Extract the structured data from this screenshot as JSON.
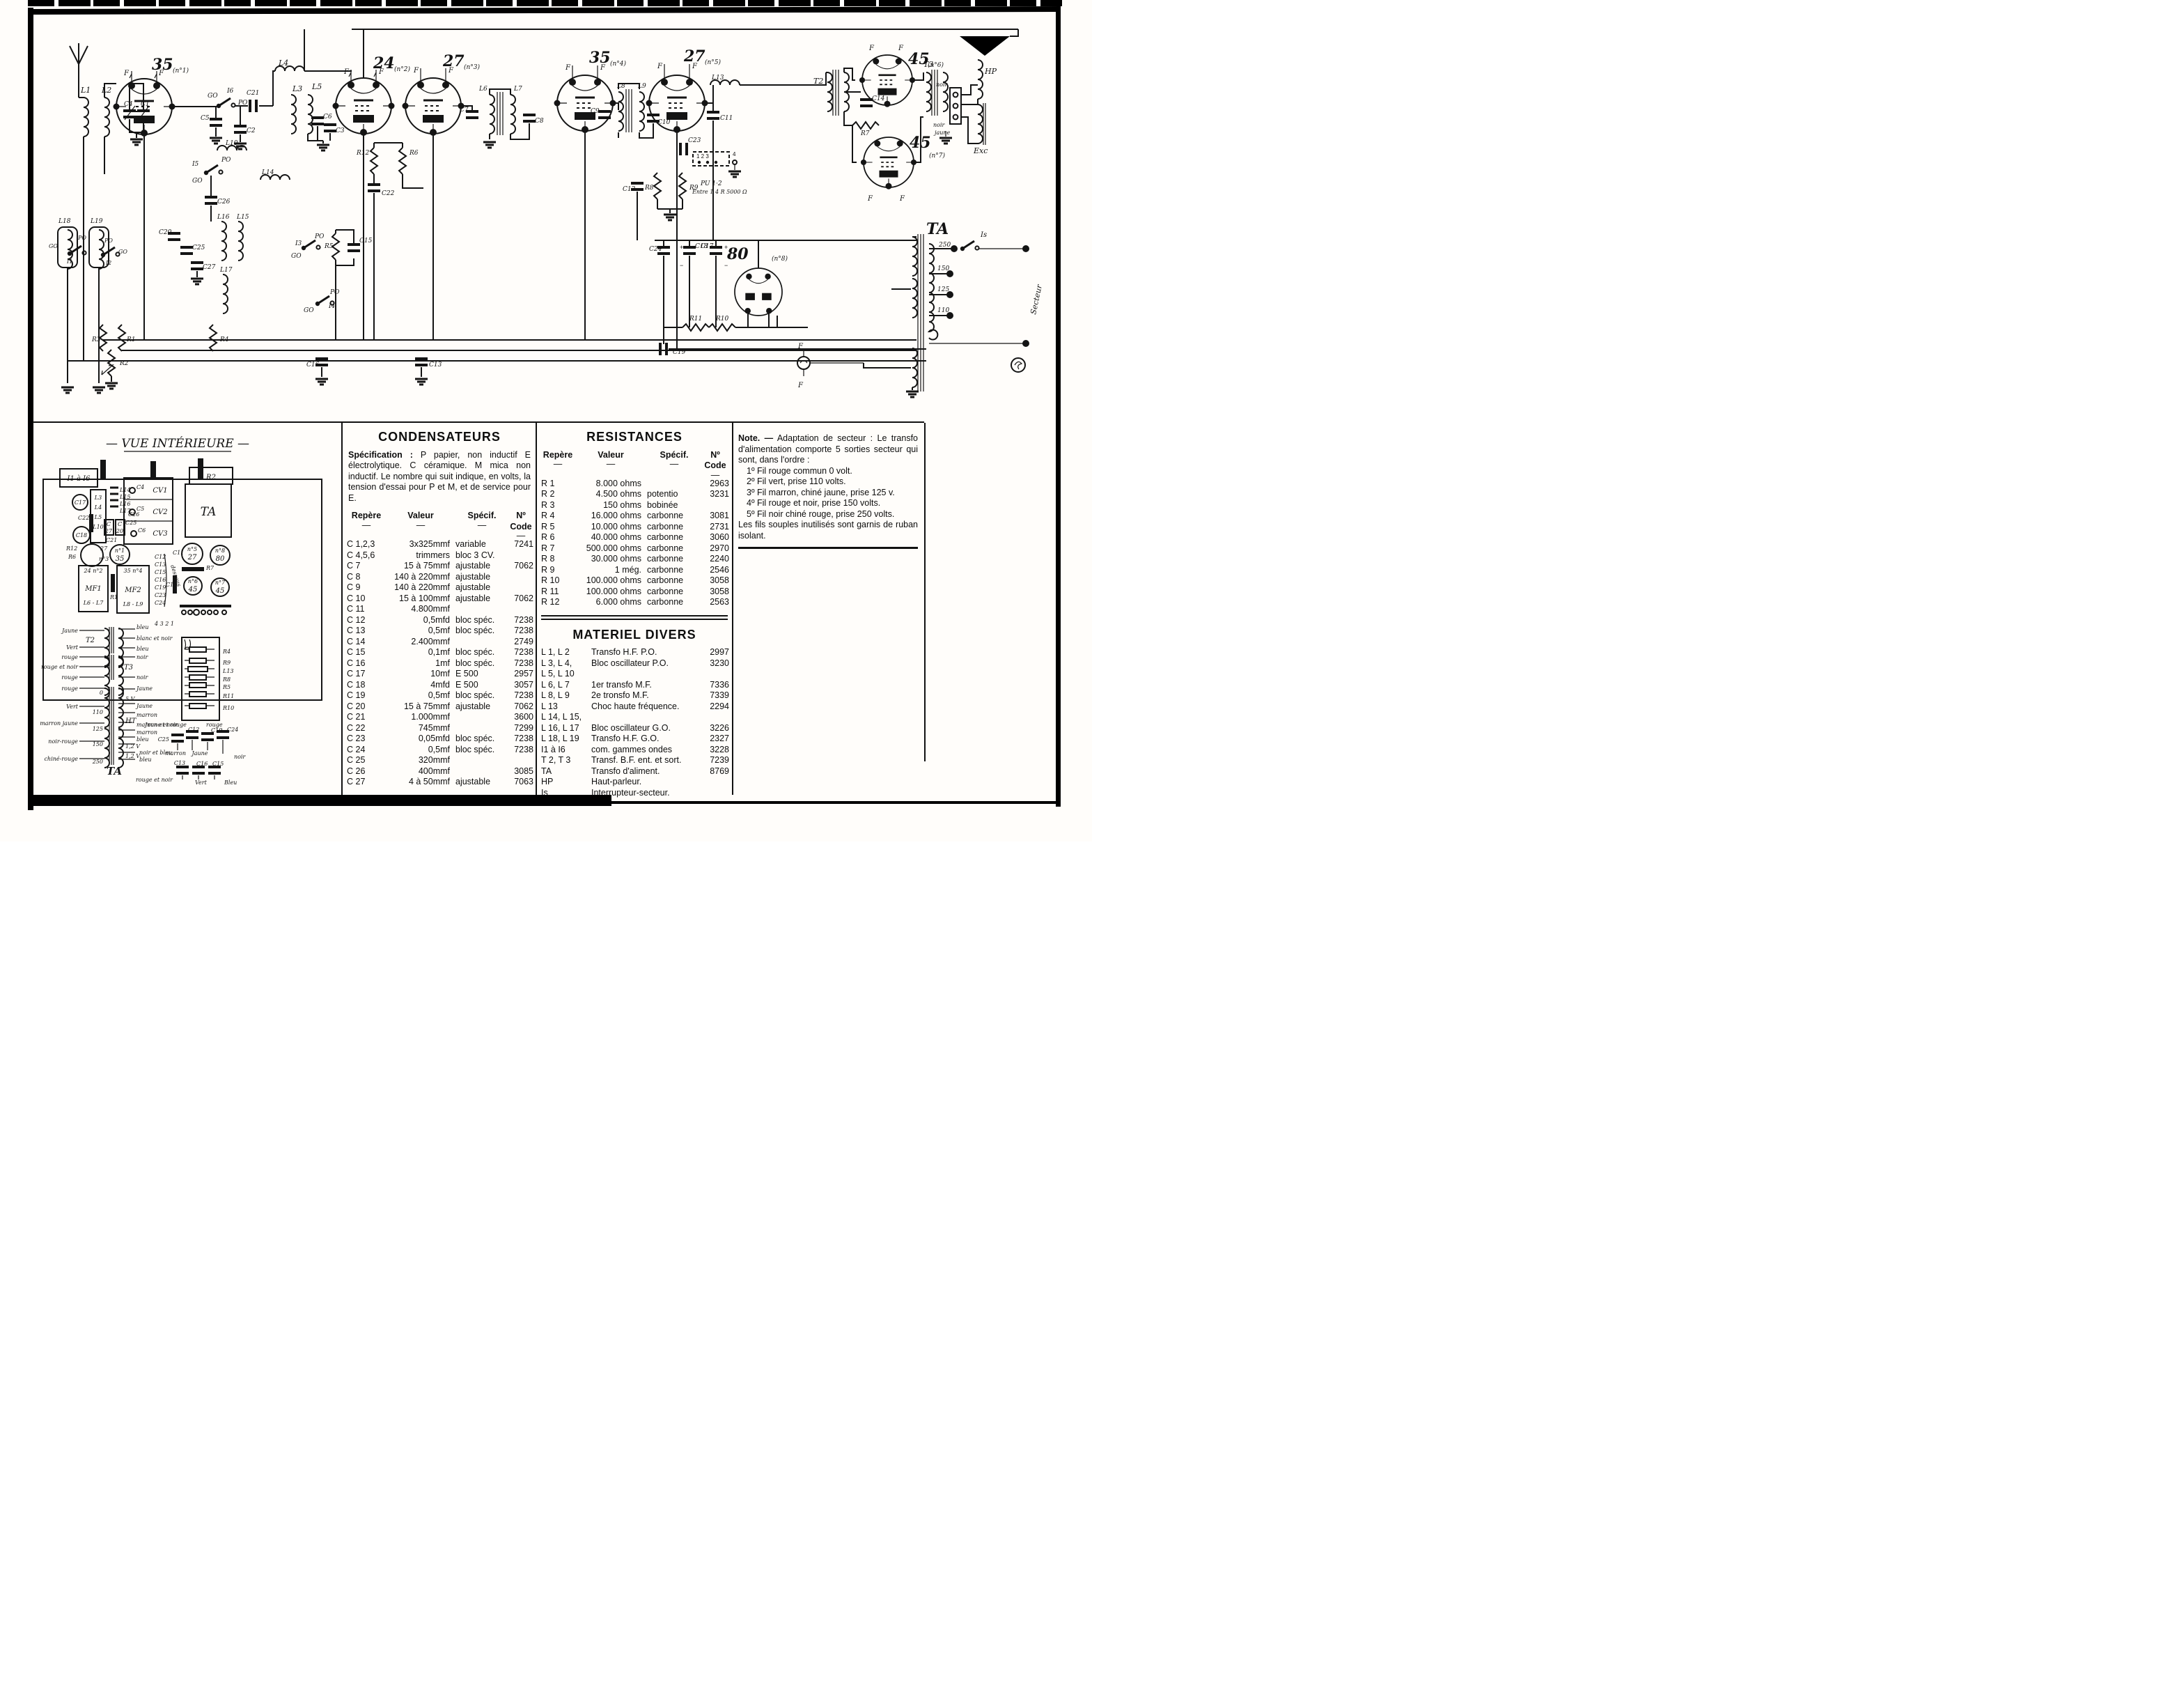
{
  "schematic": {
    "labels": {
      "v1": "35",
      "v1n": "(n°1)",
      "v2": "24",
      "v2n": "(n°2)",
      "v3": "27",
      "v3n": "(n°3)",
      "v4": "35",
      "v4n": "(n°4)",
      "v5": "27",
      "v5n": "(n°5)",
      "v6": "45",
      "v6n": "(n°6)",
      "v7": "45",
      "v7n": "(n°7)",
      "v8": "80",
      "v8n": "(n°8)",
      "f": "F",
      "l1": "L1",
      "l2": "L2",
      "l3": "L3",
      "l4": "L4",
      "l5": "L5",
      "l6": "L6",
      "l7": "L7",
      "l8": "L8",
      "l9": "L9",
      "l10": "L10",
      "l13": "L13",
      "l14": "L14",
      "l15": "L15",
      "l16": "L16",
      "l17": "L17",
      "l18": "L18",
      "l19": "L19",
      "c1": "C1",
      "c2": "C2",
      "c3": "C3",
      "c4": "C4",
      "c5": "C5",
      "c6": "C6",
      "c7": "C7",
      "c8": "C8",
      "c9": "C9",
      "c10": "C10",
      "c11": "C11",
      "c12": "C12",
      "c13": "C13",
      "c14": "C14",
      "c15": "C15",
      "c16": "C16",
      "c17": "C17",
      "c18": "C18",
      "c19": "C19",
      "c20": "C20",
      "c21": "C21",
      "c22": "C22",
      "c23": "C23",
      "c24": "C24",
      "c25": "C25",
      "c26": "C26",
      "c27": "C27",
      "r1": "R1",
      "r2": "R2",
      "r3": "R3",
      "r4": "R4",
      "r5": "R5",
      "r6": "R6",
      "r7": "R7",
      "r8": "R8",
      "r9": "R9",
      "r10": "R10",
      "r11": "R11",
      "r12": "R12",
      "i1": "I1",
      "i2": "I2",
      "i3": "I3",
      "i4": "I4",
      "i5": "I5",
      "i6": "I6",
      "po": "PO",
      "go": "GO",
      "pu": "PU 1·2",
      "punote": "Entre 1 4 R 5000 Ω",
      "k123": "1   2   3",
      "k4": "4",
      "tt2": "T2",
      "tt3": "T3",
      "ta": "TA",
      "is": "Is",
      "secteur": "Secteur",
      "hp": "HP",
      "exc": "Exc",
      "noir": "noir",
      "jaune": "jaune",
      "tap250": "250",
      "tap150": "150",
      "tap125": "125",
      "tap110": "110",
      "plus": "+",
      "minus": "−"
    }
  },
  "vue": {
    "labels": {
      "title": "— VUE INTÉRIEURE —",
      "i116": "I1 à I6",
      "r2": "R2",
      "ta": "TA",
      "cv1": "CV1",
      "cv2": "CV2",
      "cv3": "CV3",
      "c4": "C4",
      "c5": "C5",
      "c6": "C6",
      "l3": "L3",
      "l4": "L4",
      "l5": "L5",
      "l10": "L10",
      "l14": "L14",
      "l15": "L15",
      "l16": "L16",
      "l17": "L17",
      "c17": "C17",
      "c18": "C18",
      "c22": "C22",
      "c26": "C26",
      "c25": "C25",
      "c21": "C21",
      "cbox": "C",
      "n27": "27",
      "n20": "20",
      "r12": "R12",
      "r6": "R6",
      "r1": "R1",
      "r7": "R7",
      "n1": "n°1",
      "n3": "n°3",
      "n5": "n°5",
      "n6": "n°6",
      "n7": "n°7",
      "n8": "n°8",
      "t35": "35",
      "t27": "27",
      "t45": "45",
      "t80": "80",
      "mf1": "MF1",
      "mf1c": "L6 - L7",
      "mf1t": "24 n°2",
      "mf2": "MF2",
      "mf2c": "L8 - L9",
      "mf2t": "35 n°4",
      "c11": "C11",
      "c12": "C12",
      "c13": "C13",
      "c14": "C14",
      "c15": "C15",
      "c16": "C16",
      "c19": "C19",
      "c23": "C23",
      "c24": "C24",
      "dessous": "dessous",
      "digits": "4 3 2 1",
      "t2": "T2",
      "t3": "T3",
      "tabig": "TA",
      "jaune": "Jaune",
      "vert": "Vert",
      "rouge": "rouge",
      "rougeetnoir": "rouge et noir",
      "marronjaune": "marron jaune",
      "noirrouge": "noir-rouge",
      "chinerouge": "chiné-rouge",
      "bleu": "bleu",
      "blancetnoir": "blanc et noir",
      "noir": "noir",
      "marron": "marron",
      "marronetnoir": "marron et noir",
      "noiretbleu": "noir et bleu",
      "ht": "HT",
      "v5": "5 V",
      "v12": "1,2 V",
      "tap0": "0",
      "tap110": "110",
      "tap125": "125",
      "tap150": "150",
      "tap250": "250",
      "r4": "R4",
      "r9": "R9",
      "l13": "L13",
      "r8": "R8",
      "r5": "R5",
      "r11": "R11",
      "r10": "R10",
      "jauneetrouge": "Jaune et rouge",
      "bvert": "Vert",
      "bbleu": "Bleu"
    }
  },
  "ui": {
    "dash": "—"
  },
  "condensateurs": {
    "title": "CONDENSATEURS",
    "spec_bold": "Spécification :",
    "spec_rest": " P papier, non inductif E électrolytique. C céramique. M mica non inductif. Le nombre qui suit indique, en volts, la tension d'essai pour P et M, et de service pour E.",
    "headers": [
      "Repère",
      "Valeur",
      "Spécif.",
      "Nº Code"
    ],
    "rows": [
      [
        "C 1,2,3",
        "3x325mmf",
        "variable",
        "7241"
      ],
      [
        "C 4,5,6",
        "trimmers",
        "bloc 3 CV.",
        ""
      ],
      [
        "C 7",
        "15 à 75mmf",
        "ajustable",
        "7062"
      ],
      [
        "C 8",
        "140 à 220mmf",
        "ajustable",
        ""
      ],
      [
        "C 9",
        "140 à 220mmf",
        "ajustable",
        ""
      ],
      [
        "C 10",
        "15 à 100mmf",
        "ajustable",
        "7062"
      ],
      [
        "C 11",
        "4.800mmf",
        "",
        ""
      ],
      [
        "C 12",
        "0,5mfd",
        "bloc spéc.",
        "7238"
      ],
      [
        "C 13",
        "0,5mf",
        "bloc spéc.",
        "7238"
      ],
      [
        "C 14",
        "2.400mmf",
        "",
        "2749"
      ],
      [
        "C 15",
        "0,1mf",
        "bloc spéc.",
        "7238"
      ],
      [
        "C 16",
        "1mf",
        "bloc spéc.",
        "7238"
      ],
      [
        "C 17",
        "10mf",
        "E 500",
        "2957"
      ],
      [
        "C 18",
        "4mfd",
        "E 500",
        "3057"
      ],
      [
        "C 19",
        "0,5mf",
        "bloc spéc.",
        "7238"
      ],
      [
        "C 20",
        "15 à 75mmf",
        "ajustable",
        "7062"
      ],
      [
        "C 21",
        "1.000mmf",
        "",
        "3600"
      ],
      [
        "C 22",
        "745mmf",
        "",
        "7299"
      ],
      [
        "C 23",
        "0,05mfd",
        "bloc spéc.",
        "7238"
      ],
      [
        "C 24",
        "0,5mf",
        "bloc spéc.",
        "7238"
      ],
      [
        "C 25",
        "320mmf",
        "",
        ""
      ],
      [
        "C 26",
        "400mmf",
        "",
        "3085"
      ],
      [
        "C 27",
        "4 à 50mmf",
        "ajustable",
        "7063"
      ]
    ]
  },
  "resistances": {
    "title": "RESISTANCES",
    "headers": [
      "Repère",
      "Valeur",
      "Spécif.",
      "Nº Code"
    ],
    "rows": [
      [
        "R 1",
        "8.000 ohms",
        "",
        "2963"
      ],
      [
        "R 2",
        "4.500 ohms",
        "potentio",
        "3231"
      ],
      [
        "R 3",
        "150 ohms",
        "bobinée",
        ""
      ],
      [
        "R 4",
        "16.000 ohms",
        "carbonne",
        "3081"
      ],
      [
        "R 5",
        "10.000 ohms",
        "carbonne",
        "2731"
      ],
      [
        "R 6",
        "40.000 ohms",
        "carbonne",
        "3060"
      ],
      [
        "R 7",
        "500.000 ohms",
        "carbonne",
        "2970"
      ],
      [
        "R 8",
        "30.000 ohms",
        "carbonne",
        "2240"
      ],
      [
        "R 9",
        "1 még.",
        "carbonne",
        "2546"
      ],
      [
        "R 10",
        "100.000 ohms",
        "carbonne",
        "3058"
      ],
      [
        "R 11",
        "100.000 ohms",
        "carbonne",
        "3058"
      ],
      [
        "R 12",
        "6.000 ohms",
        "carbonne",
        "2563"
      ]
    ]
  },
  "materiel": {
    "title": "MATERIEL  DIVERS",
    "rows": [
      [
        "L 1, L 2",
        "Transfo H.F. P.O.",
        "2997"
      ],
      [
        "L 3, L 4,",
        "Bloc oscillateur P.O.",
        "3230"
      ],
      [
        "L 5, L 10",
        "",
        ""
      ],
      [
        "L 6, L 7",
        "1er transfo M.F.",
        "7336"
      ],
      [
        "L 8, L 9",
        "2e tronsfo M.F.",
        "7339"
      ],
      [
        "L 13",
        "Choc haute fréquence.",
        "2294"
      ],
      [
        "L 14, L 15,",
        "",
        ""
      ],
      [
        "L 16, L 17",
        "Bloc oscillateur G.O.",
        "3226"
      ],
      [
        "L 18, L 19",
        "Transfo H.F. G.O.",
        "2327"
      ],
      [
        "I1 à I6",
        "com. gammes ondes",
        "3228"
      ],
      [
        "T 2, T 3",
        "Transf. B.F. ent. et sort.",
        "7239"
      ],
      [
        "TA",
        "Transfo d'aliment.",
        "8769"
      ],
      [
        "HP",
        "Haut-parleur.",
        ""
      ],
      [
        "Is",
        "Interrupteur-secteur.",
        ""
      ]
    ]
  },
  "note": {
    "bold": "Note.",
    "dash": "—",
    "intro": "Adaptation de secteur : Le transfo d'alimentation comporte 5 sorties secteur qui sont, dans l'ordre :",
    "items": [
      "1º Fil rouge commun 0 volt.",
      "2º Fil vert, prise 110 volts.",
      "3º Fil marron, chiné jaune, prise 125 v.",
      "4º Fil rouge et noir, prise 150 volts.",
      "5º Fil noir chiné rouge, prise 250 volts."
    ],
    "outro": "Les fils souples inutilisés sont garnis de ruban isolant."
  }
}
